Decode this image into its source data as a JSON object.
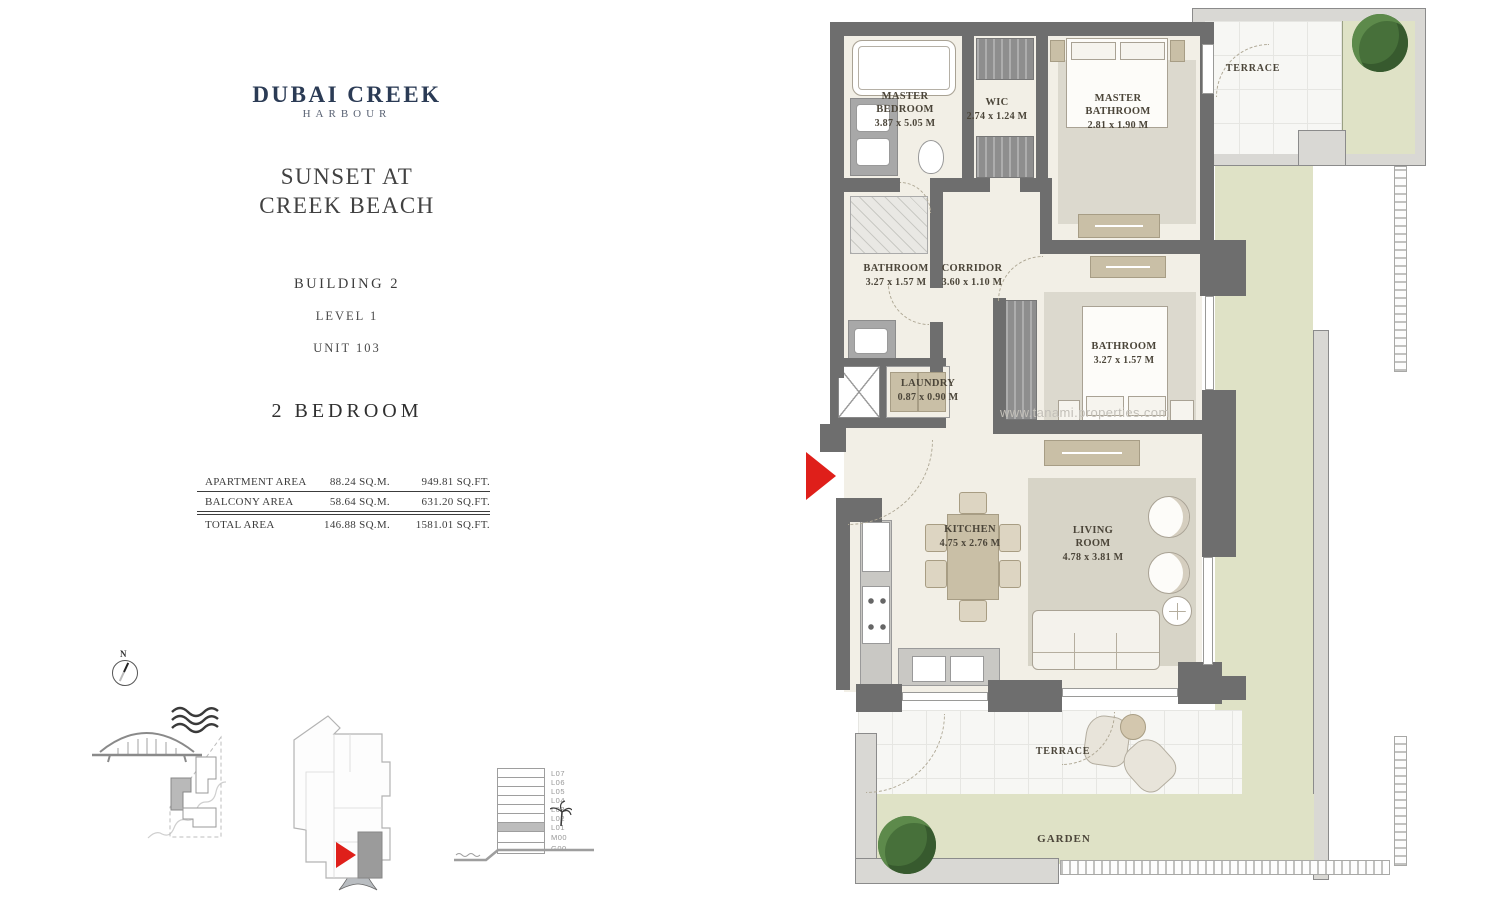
{
  "brand": {
    "logo_line1": "DUBAI CREEK",
    "logo_line2": "HARBOUR"
  },
  "project": {
    "title_line1": "SUNSET AT",
    "title_line2": "CREEK BEACH",
    "building": "BUILDING 2",
    "level": "LEVEL 1",
    "unit": "UNIT 103",
    "type": "2 BEDROOM"
  },
  "area_table": {
    "rows": [
      {
        "label": "APARTMENT AREA",
        "sqm": "88.24 SQ.M.",
        "sqft": "949.81 SQ.FT."
      },
      {
        "label": "BALCONY AREA",
        "sqm": "58.64 SQ.M.",
        "sqft": "631.20 SQ.FT."
      },
      {
        "label": "TOTAL AREA",
        "sqm": "146.88 SQ.M.",
        "sqft": "1581.01 SQ.FT."
      }
    ]
  },
  "floor_plan": {
    "rooms": [
      {
        "name": "MASTER BEDROOM",
        "dims": "3.87 x 5.05 M"
      },
      {
        "name": "WIC",
        "dims": "2.74 x 1.24 M"
      },
      {
        "name": "MASTER BATHROOM",
        "dims": "2.81 x 1.90 M"
      },
      {
        "name": "TERRACE",
        "dims": ""
      },
      {
        "name": "BATHROOM",
        "dims": "3.27 x 1.57 M"
      },
      {
        "name": "CORRIDOR",
        "dims": "3.60 x 1.10 M"
      },
      {
        "name": "BATHROOM",
        "dims": "3.27 x 1.57 M"
      },
      {
        "name": "LAUNDRY",
        "dims": "0.87 x 0.90 M"
      },
      {
        "name": "KITCHEN",
        "dims": "4.75 x 2.76 M"
      },
      {
        "name": "LIVING ROOM",
        "dims": "4.78 x 3.81 M"
      },
      {
        "name": "TERRACE",
        "dims": ""
      },
      {
        "name": "GARDEN",
        "dims": ""
      }
    ],
    "watermark": "www.tanami.properties.com"
  },
  "diagrams": {
    "compass_label": "N",
    "levels": [
      "L07",
      "L06",
      "L05",
      "L04",
      "L03",
      "L02",
      "L01",
      "M00",
      "G00"
    ],
    "highlighted_level": "L01"
  },
  "colors": {
    "brand_navy": "#2b3b55",
    "accent_red": "#df1f1a",
    "wall_gray": "#6e6e6e",
    "garden_green": "#dfe2c6"
  }
}
